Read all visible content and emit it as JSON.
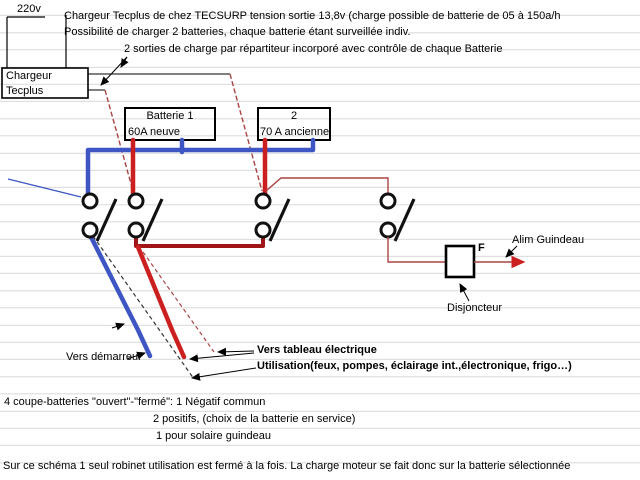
{
  "diagram": {
    "header": {
      "line1": "Chargeur Tecplus de chez TECSURP tension sortie 13,8v (charge possible de batterie de 05 à 150a/h",
      "line2": "Possibilité de charger 2 batteries, chaque batterie étant surveillée indiv.",
      "line3": "2 sorties de charge par répartiteur incorporé avec contrôle de chaque Batterie"
    },
    "labels": {
      "supply_voltage": "220v",
      "charger_line1": "Chargeur",
      "charger_line2": "Tecplus",
      "battery1_line1": "Batterie 1",
      "battery1_line2": "60A neuve",
      "battery2_line1": "2",
      "battery2_line2": "70 A ancienne",
      "breaker_letter": "F",
      "alim_guindeau": "Alim Guindeau",
      "disjoncteur": "Disjoncteur",
      "vers_demarreur": "Vers démarreur",
      "vers_tableau_line1": "Vers tableau électrique",
      "vers_tableau_line2": "Utilisation(feux, pompes, éclairage int.,électronique, frigo…)"
    },
    "notes": {
      "line1": "4 coupe-batteries \"ouvert\"-\"fermé\": 1 Négatif commun",
      "line2": "2 positifs, (choix de la batterie en service)",
      "line3": "1 pour solaire guindeau",
      "footer": "Sur ce schéma 1 seul robinet utilisation est fermé à la fois. La charge moteur se fait donc sur la batterie sélectionnée"
    },
    "colors": {
      "positive_wire": "#cc2020",
      "positive_bus": "#a01515",
      "negative_wire": "#3d56c4",
      "charge_wire": "#aa4444",
      "annotation": "#000000",
      "gridline": "#d9d9d9"
    }
  }
}
